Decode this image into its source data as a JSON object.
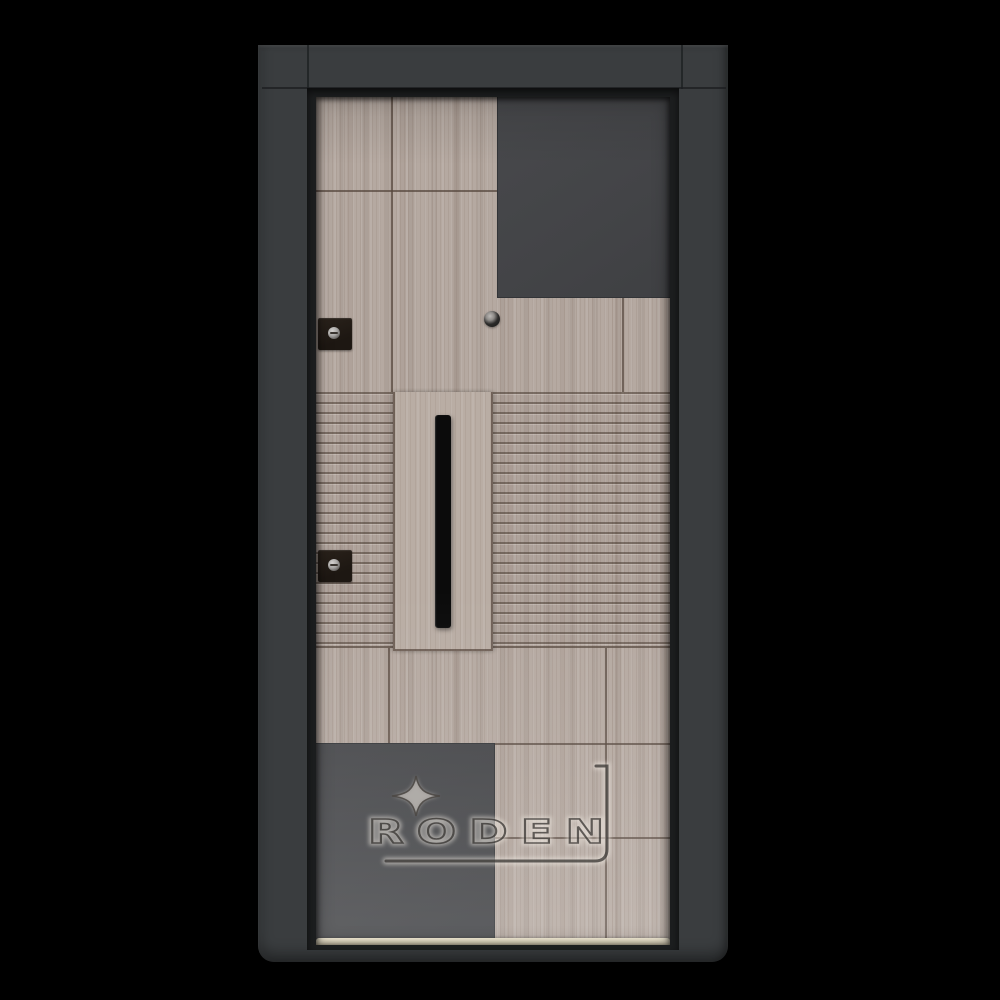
{
  "watermark": {
    "brand": "RODEN"
  },
  "icons": {
    "star": "four-pointed-sparkle"
  },
  "palette": {
    "background": "#000000",
    "frame_charcoal": "#3a3d3f",
    "door_panel_dark": "#454649",
    "wood_light_oak": "#b5a9a1",
    "wood_seam": "#54453b",
    "handle_black": "#0b0b0b",
    "threshold_cream": "#e7ddc2",
    "lock_dark_bronze": "#1d1712",
    "watermark_stroke": "#3a3734",
    "watermark_glow": "#f2ece4"
  }
}
